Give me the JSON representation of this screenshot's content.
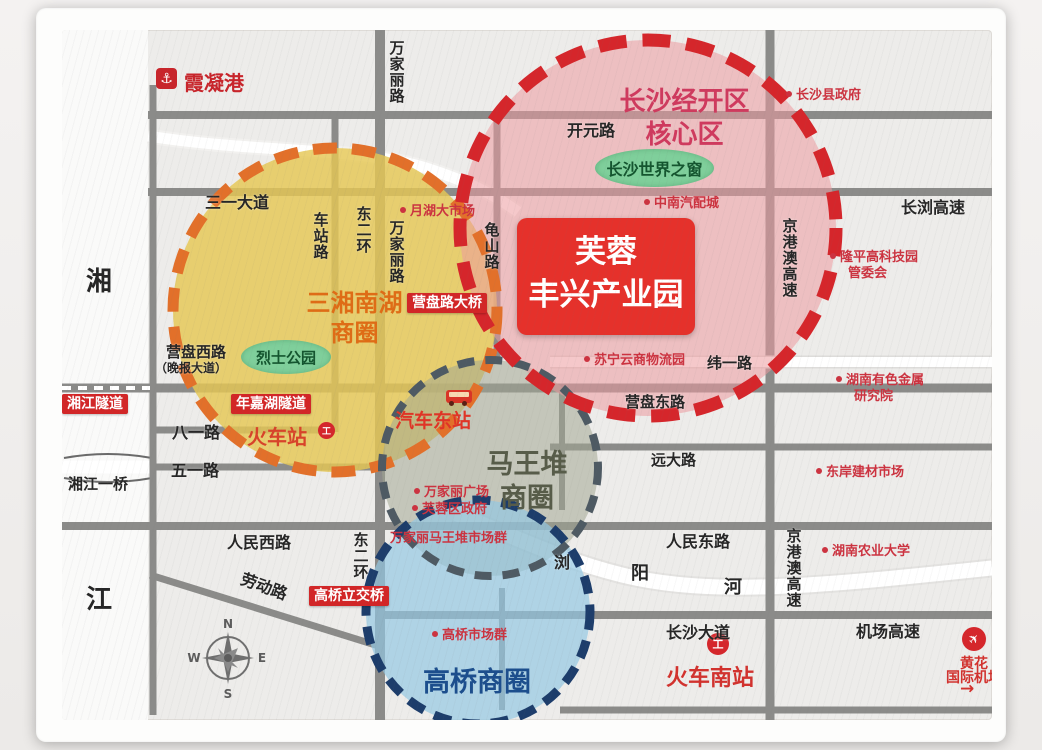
{
  "title": "芙蓉丰兴产业园区位图",
  "colors": {
    "map_bg": "#edecea",
    "road_gray": "#8b8b89",
    "river_white": "#fafaf9",
    "site_red": "#e5312b",
    "badge_red": "#d22627",
    "poi_red": "#cc3340",
    "zone_jingkai_border": "#d5262b",
    "zone_jingkai_fill": "rgba(236,154,158,0.55)",
    "zone_jingkai_title": "#cf3a5e",
    "zone_sanxiang_border": "#e2702a",
    "zone_sanxiang_fill": "rgba(229,199,84,0.82)",
    "zone_sanxiang_title": "#df6c16",
    "zone_mawangdui_border": "#4e5a63",
    "zone_mawangdui_fill": "rgba(163,168,146,0.55)",
    "zone_mawangdui_title": "#575c49",
    "zone_gaoqiao_border": "#1d3d6b",
    "zone_gaoqiao_fill": "rgba(146,199,227,0.68)",
    "zone_gaoqiao_title": "#1c4e8d",
    "park_green": "#7fcf9b"
  },
  "site": {
    "line1": "芙蓉",
    "line2": "丰兴产业园"
  },
  "zones": {
    "jingkai": {
      "line1": "长沙经开区",
      "line2": "核心区"
    },
    "sanxiang": {
      "line1": "三湘南湖",
      "line2": "商圈"
    },
    "mawangdui": {
      "line1": "马王堆",
      "line2": "商圈"
    },
    "gaoqiao": {
      "label": "高桥商圈"
    }
  },
  "parks": [
    {
      "label": "长沙世界之窗"
    },
    {
      "label": "烈士公园"
    }
  ],
  "stations": {
    "port": {
      "label": "霞凝港",
      "icon": "anchor"
    },
    "railway": {
      "label": "火车站",
      "icon": "rail-logo",
      "glyph": "工"
    },
    "bus_east": {
      "label": "汽车东站",
      "icon": "bus"
    },
    "railway_south": {
      "label": "火车南站",
      "icon": "rail-logo",
      "glyph": "工"
    },
    "airport": {
      "line1": "黄花",
      "line2": "国际机场",
      "icon": "plane",
      "glyph": "✈",
      "arrow": "→"
    }
  },
  "labels": [
    {
      "t": "万家丽路",
      "x": 326,
      "y": 10,
      "fs": 15,
      "v": 1
    },
    {
      "t": "三一大道",
      "x": 143,
      "y": 164,
      "fs": 16
    },
    {
      "t": "车站路",
      "x": 250,
      "y": 182,
      "fs": 15,
      "v": 1
    },
    {
      "t": "东二环",
      "x": 293,
      "y": 176,
      "fs": 15,
      "v": 1
    },
    {
      "t": "万家丽路",
      "x": 326,
      "y": 190,
      "fs": 15,
      "v": 1
    },
    {
      "t": "龟山路",
      "x": 421,
      "y": 192,
      "fs": 15,
      "v": 1
    },
    {
      "t": "开元路",
      "x": 505,
      "y": 92,
      "fs": 16
    },
    {
      "t": "长浏高速",
      "x": 839,
      "y": 169,
      "fs": 16
    },
    {
      "t": "京港澳高速",
      "x": 719,
      "y": 188,
      "fs": 15,
      "v": 1
    },
    {
      "t": "纬一路",
      "x": 645,
      "y": 325,
      "fs": 15
    },
    {
      "t": "营盘东路",
      "x": 563,
      "y": 364,
      "fs": 15
    },
    {
      "t": "营盘西路",
      "x": 104,
      "y": 314,
      "fs": 15
    },
    {
      "t": "（晚报大道）",
      "x": 93,
      "y": 332,
      "fs": 12
    },
    {
      "t": "八一路",
      "x": 110,
      "y": 394,
      "fs": 16
    },
    {
      "t": "五一路",
      "x": 109,
      "y": 432,
      "fs": 16
    },
    {
      "t": "远大路",
      "x": 589,
      "y": 422,
      "fs": 15
    },
    {
      "t": "人民西路",
      "x": 165,
      "y": 504,
      "fs": 16
    },
    {
      "t": "人民东路",
      "x": 604,
      "y": 503,
      "fs": 16
    },
    {
      "t": "东二环",
      "x": 290,
      "y": 502,
      "fs": 15,
      "v": 1
    },
    {
      "t": "劳动路",
      "x": 178,
      "y": 548,
      "fs": 16,
      "rot": 20
    },
    {
      "t": "长沙大道",
      "x": 604,
      "y": 594,
      "fs": 16
    },
    {
      "t": "机场高速",
      "x": 794,
      "y": 593,
      "fs": 16
    },
    {
      "t": "京港澳高速",
      "x": 723,
      "y": 498,
      "fs": 15,
      "v": 1
    },
    {
      "t": "湘",
      "x": 24,
      "y": 238,
      "fs": 26
    },
    {
      "t": "江",
      "x": 24,
      "y": 556,
      "fs": 26
    },
    {
      "t": "浏",
      "x": 492,
      "y": 524,
      "fs": 16
    },
    {
      "t": "阳",
      "x": 569,
      "y": 534,
      "fs": 18
    },
    {
      "t": "河",
      "x": 662,
      "y": 548,
      "fs": 18
    },
    {
      "t": "湘江一桥",
      "x": 6,
      "y": 446,
      "fs": 15
    }
  ],
  "badges": [
    {
      "t": "湘江隧道",
      "x": 0,
      "y": 364
    },
    {
      "t": "年嘉湖隧道",
      "x": 169,
      "y": 364
    },
    {
      "t": "营盘路大桥",
      "x": 345,
      "y": 263
    },
    {
      "t": "高桥立交桥",
      "x": 247,
      "y": 556
    }
  ],
  "pois": [
    {
      "lines": [
        "长沙县政府"
      ],
      "x": 724,
      "y": 58,
      "dot": 1
    },
    {
      "lines": [
        "隆平高科技园",
        "管委会"
      ],
      "x": 768,
      "y": 220,
      "dot": 1
    },
    {
      "lines": [
        "中南汽配城"
      ],
      "x": 582,
      "y": 166,
      "dot": 1
    },
    {
      "lines": [
        "月湖大市场"
      ],
      "x": 338,
      "y": 174,
      "dot": 1
    },
    {
      "lines": [
        "苏宁云商物流园"
      ],
      "x": 522,
      "y": 323,
      "dot": 1
    },
    {
      "lines": [
        "湖南有色金属",
        "研究院"
      ],
      "x": 774,
      "y": 343,
      "dot": 1
    },
    {
      "lines": [
        "东岸建材市场"
      ],
      "x": 754,
      "y": 435,
      "dot": 1
    },
    {
      "lines": [
        "湖南农业大学"
      ],
      "x": 760,
      "y": 514,
      "dot": 1
    },
    {
      "lines": [
        "万家丽广场"
      ],
      "x": 352,
      "y": 455,
      "dot": 1
    },
    {
      "lines": [
        "芙蓉区政府"
      ],
      "x": 350,
      "y": 472,
      "dot": 1
    },
    {
      "lines": [
        "万家丽马王堆市场群"
      ],
      "x": 328,
      "y": 501,
      "dot": 0
    },
    {
      "lines": [
        "高桥市场群"
      ],
      "x": 370,
      "y": 598,
      "dot": 1
    }
  ],
  "compass": {
    "n": "N",
    "e": "E",
    "s": "S",
    "w": "W"
  }
}
